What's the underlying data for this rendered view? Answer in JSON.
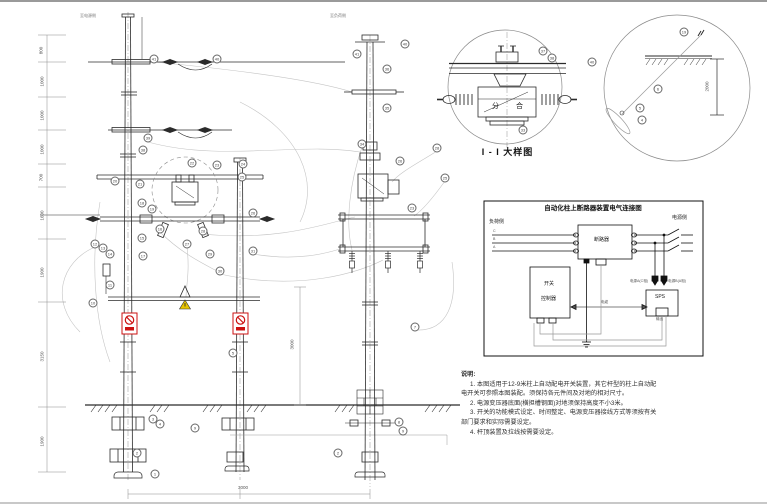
{
  "colors": {
    "line": "#2b2b2b",
    "light": "#9a9a9a",
    "red": "#cc1111",
    "yellow": "#e8c400"
  },
  "top_labels": {
    "left": "至电源侧",
    "right": "至负荷侧"
  },
  "detail1": {
    "title": "I - I 大样图",
    "open": "分",
    "close": "合"
  },
  "detail2": {
    "dim": "2000"
  },
  "dims": {
    "bottom": "3000",
    "side": "3000"
  },
  "left_ruler": {
    "labels": [
      {
        "y": 46,
        "v": "800"
      },
      {
        "y": 77,
        "v": "1000"
      },
      {
        "y": 111,
        "v": "1000"
      },
      {
        "y": 145,
        "v": "1000"
      },
      {
        "y": 173,
        "v": "700"
      },
      {
        "y": 211,
        "v": "1600"
      },
      {
        "y": 268,
        "v": "1900"
      },
      {
        "y": 352,
        "v": "3150"
      },
      {
        "y": 437,
        "v": "1900"
      }
    ]
  },
  "wiring": {
    "title": "自动化柱上断路器装置电气连接图",
    "load_side": "负荷侧",
    "source_side": "电源侧",
    "phases": [
      "C",
      "B",
      "A"
    ],
    "breaker": "断路器",
    "controller_line1": "开关",
    "controller_line2": "控制器",
    "sps": "SPS",
    "sps_in_a": "电源A(C相)",
    "sps_in_b": "电源B(A相)",
    "cable_label": "电缆",
    "out_label": "输出"
  },
  "notes": {
    "heading": "说明:",
    "lines": [
      {
        "text": "1. 本图适用于12-9米柱上自动配电开关装置，其它杆型的柱上自动配",
        "indent": true
      },
      {
        "text": "电开关可参照本图装配。须保持各元件间及对地的相对尺寸。",
        "indent": false
      },
      {
        "text": "2. 电源变压器底面(横担槽钢面)对地须保持高度不小3米。",
        "indent": true
      },
      {
        "text": "3. 开关的功能模式设定、时间整定、电源变压器接线方式等须按有关",
        "indent": true
      },
      {
        "text": "部门要求和实际需要设定。",
        "indent": false
      },
      {
        "text": "4. 杆顶装置及拉线按需要设定。",
        "indent": true
      }
    ]
  },
  "callouts": [
    {
      "x": 154,
      "y": 57,
      "n": "41"
    },
    {
      "x": 217,
      "y": 57,
      "n": "40"
    },
    {
      "x": 148,
      "y": 136,
      "n": "39"
    },
    {
      "x": 143,
      "y": 148,
      "n": "38"
    },
    {
      "x": 192,
      "y": 161,
      "n": "22"
    },
    {
      "x": 217,
      "y": 163,
      "n": "23"
    },
    {
      "x": 243,
      "y": 162,
      "n": "24"
    },
    {
      "x": 115,
      "y": 179,
      "n": "20"
    },
    {
      "x": 140,
      "y": 182,
      "n": "21"
    },
    {
      "x": 242,
      "y": 175,
      "n": "25"
    },
    {
      "x": 253,
      "y": 211,
      "n": "26"
    },
    {
      "x": 142,
      "y": 201,
      "n": "18"
    },
    {
      "x": 152,
      "y": 207,
      "n": "19"
    },
    {
      "x": 160,
      "y": 227,
      "n": "16"
    },
    {
      "x": 142,
      "y": 236,
      "n": "15"
    },
    {
      "x": 95,
      "y": 242,
      "n": "12"
    },
    {
      "x": 103,
      "y": 246,
      "n": "13"
    },
    {
      "x": 110,
      "y": 252,
      "n": "14"
    },
    {
      "x": 187,
      "y": 242,
      "n": "27"
    },
    {
      "x": 203,
      "y": 229,
      "n": "28"
    },
    {
      "x": 210,
      "y": 252,
      "n": "29"
    },
    {
      "x": 220,
      "y": 269,
      "n": "30"
    },
    {
      "x": 253,
      "y": 249,
      "n": "31"
    },
    {
      "x": 110,
      "y": 283,
      "n": "11"
    },
    {
      "x": 93,
      "y": 301,
      "n": "10"
    },
    {
      "x": 143,
      "y": 254,
      "n": "17"
    },
    {
      "x": 153,
      "y": 417,
      "n": "3"
    },
    {
      "x": 160,
      "y": 422,
      "n": "4"
    },
    {
      "x": 195,
      "y": 426,
      "n": "9"
    },
    {
      "x": 137,
      "y": 451,
      "n": "2"
    },
    {
      "x": 155,
      "y": 472,
      "n": "1"
    },
    {
      "x": 233,
      "y": 351,
      "n": "5"
    },
    {
      "x": 405,
      "y": 42,
      "n": "40"
    },
    {
      "x": 357,
      "y": 52,
      "n": "41"
    },
    {
      "x": 387,
      "y": 67,
      "n": "36"
    },
    {
      "x": 387,
      "y": 106,
      "n": "35"
    },
    {
      "x": 362,
      "y": 142,
      "n": "34"
    },
    {
      "x": 437,
      "y": 146,
      "n": "28"
    },
    {
      "x": 400,
      "y": 159,
      "n": "26"
    },
    {
      "x": 445,
      "y": 176,
      "n": "25"
    },
    {
      "x": 412,
      "y": 206,
      "n": "23"
    },
    {
      "x": 415,
      "y": 325,
      "n": "7"
    },
    {
      "x": 338,
      "y": 451,
      "n": "2"
    },
    {
      "x": 399,
      "y": 420,
      "n": "8"
    },
    {
      "x": 403,
      "y": 429,
      "n": "9"
    },
    {
      "x": 543,
      "y": 49,
      "n": "37"
    },
    {
      "x": 552,
      "y": 56,
      "n": "38"
    },
    {
      "x": 592,
      "y": 60,
      "n": "40"
    },
    {
      "x": 523,
      "y": 128,
      "n": "33"
    },
    {
      "x": 684,
      "y": 30,
      "n": "19"
    },
    {
      "x": 658,
      "y": 87,
      "n": "6"
    },
    {
      "x": 640,
      "y": 106,
      "n": "5"
    },
    {
      "x": 642,
      "y": 118,
      "n": "4"
    }
  ]
}
